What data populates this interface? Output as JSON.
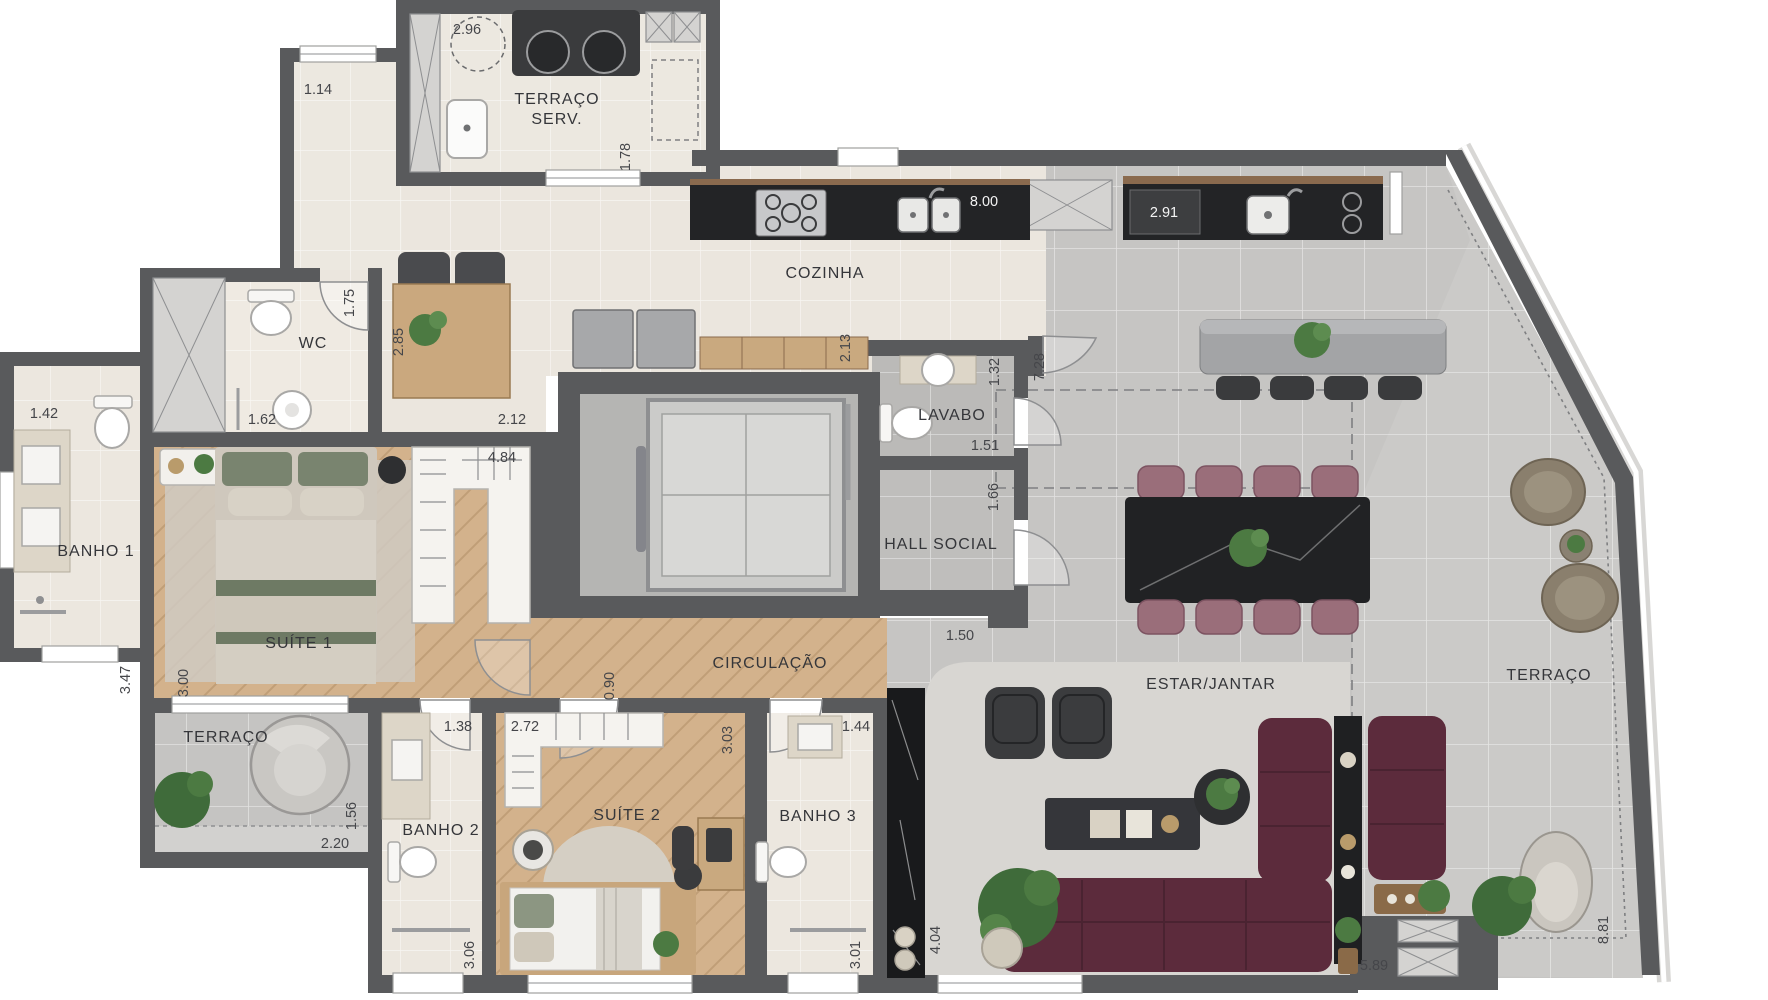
{
  "plan_type": "apartment-floor-plan",
  "rooms": [
    {
      "id": "terraco-serv-line1",
      "label": "TERRAÇO"
    },
    {
      "id": "terraco-serv-line2",
      "label": "SERV."
    },
    {
      "id": "cozinha",
      "label": "COZINHA"
    },
    {
      "id": "wc",
      "label": "WC"
    },
    {
      "id": "lavabo",
      "label": "LAVABO"
    },
    {
      "id": "hall-social",
      "label": "HALL SOCIAL"
    },
    {
      "id": "banho-1",
      "label": "BANHO 1"
    },
    {
      "id": "suite-1",
      "label": "SUÍTE 1"
    },
    {
      "id": "circulacao",
      "label": "CIRCULAÇÃO"
    },
    {
      "id": "estar-jantar",
      "label": "ESTAR/JANTAR"
    },
    {
      "id": "terraco-direita",
      "label": "TERRAÇO"
    },
    {
      "id": "terraco-esquerda",
      "label": "TERRAÇO"
    },
    {
      "id": "banho-2",
      "label": "BANHO 2"
    },
    {
      "id": "suite-2",
      "label": "SUÍTE 2"
    },
    {
      "id": "banho-3",
      "label": "BANHO 3"
    }
  ],
  "dims": [
    {
      "id": "terraco-serv-circle",
      "v": "2.96"
    },
    {
      "id": "terraco-esq-sup",
      "v": "1.14"
    },
    {
      "id": "terraco-serv-lado",
      "v": "1.78"
    },
    {
      "id": "cozinha-largura",
      "v": "8.00"
    },
    {
      "id": "gourmet-bancada",
      "v": "2.91"
    },
    {
      "id": "wc-lado",
      "v": "1.75"
    },
    {
      "id": "mesa-apoio",
      "v": "2.85"
    },
    {
      "id": "wc-largura",
      "v": "1.62"
    },
    {
      "id": "closet-sup",
      "v": "2.12"
    },
    {
      "id": "closet-larg",
      "v": "4.84"
    },
    {
      "id": "cozinha-lado",
      "v": "2.13"
    },
    {
      "id": "lavabo-larg",
      "v": "1.32"
    },
    {
      "id": "estar-lado",
      "v": "7.28"
    },
    {
      "id": "lavabo-prof",
      "v": "1.51"
    },
    {
      "id": "hall-lado",
      "v": "1.66"
    },
    {
      "id": "hall-larg",
      "v": "1.50"
    },
    {
      "id": "banho1-larg",
      "v": "1.42"
    },
    {
      "id": "banho1-alt",
      "v": "3.47"
    },
    {
      "id": "suite1-alt",
      "v": "3.00"
    },
    {
      "id": "circulacao-larg",
      "v": "0.90"
    },
    {
      "id": "banho2-larg",
      "v": "1.38"
    },
    {
      "id": "suite2-larg",
      "v": "2.72"
    },
    {
      "id": "suite2-alt",
      "v": "3.03"
    },
    {
      "id": "banho3-larg",
      "v": "1.44"
    },
    {
      "id": "terraco-esq-lado",
      "v": "1.56"
    },
    {
      "id": "terraco-esq-larg",
      "v": "2.20"
    },
    {
      "id": "banho2-alt",
      "v": "3.06"
    },
    {
      "id": "banho3-alt",
      "v": "3.01"
    },
    {
      "id": "estar-prof",
      "v": "4.04"
    },
    {
      "id": "estar-larg",
      "v": "5.89"
    },
    {
      "id": "terraco-dir-alt",
      "v": "8.81"
    }
  ],
  "colors": {
    "wall": "#595a5c",
    "wood_floor": "#d3b28c",
    "cream_tile": "#ebe6de",
    "gray_tile": "#c6c5c3",
    "sofa": "#5c2b3c",
    "dining_chair": "#9a6e7a",
    "dark_counter": "#232426",
    "plant": "#4c7a42",
    "rug": "#d8d6d2",
    "elevator_cab": "#b7b7b5"
  }
}
